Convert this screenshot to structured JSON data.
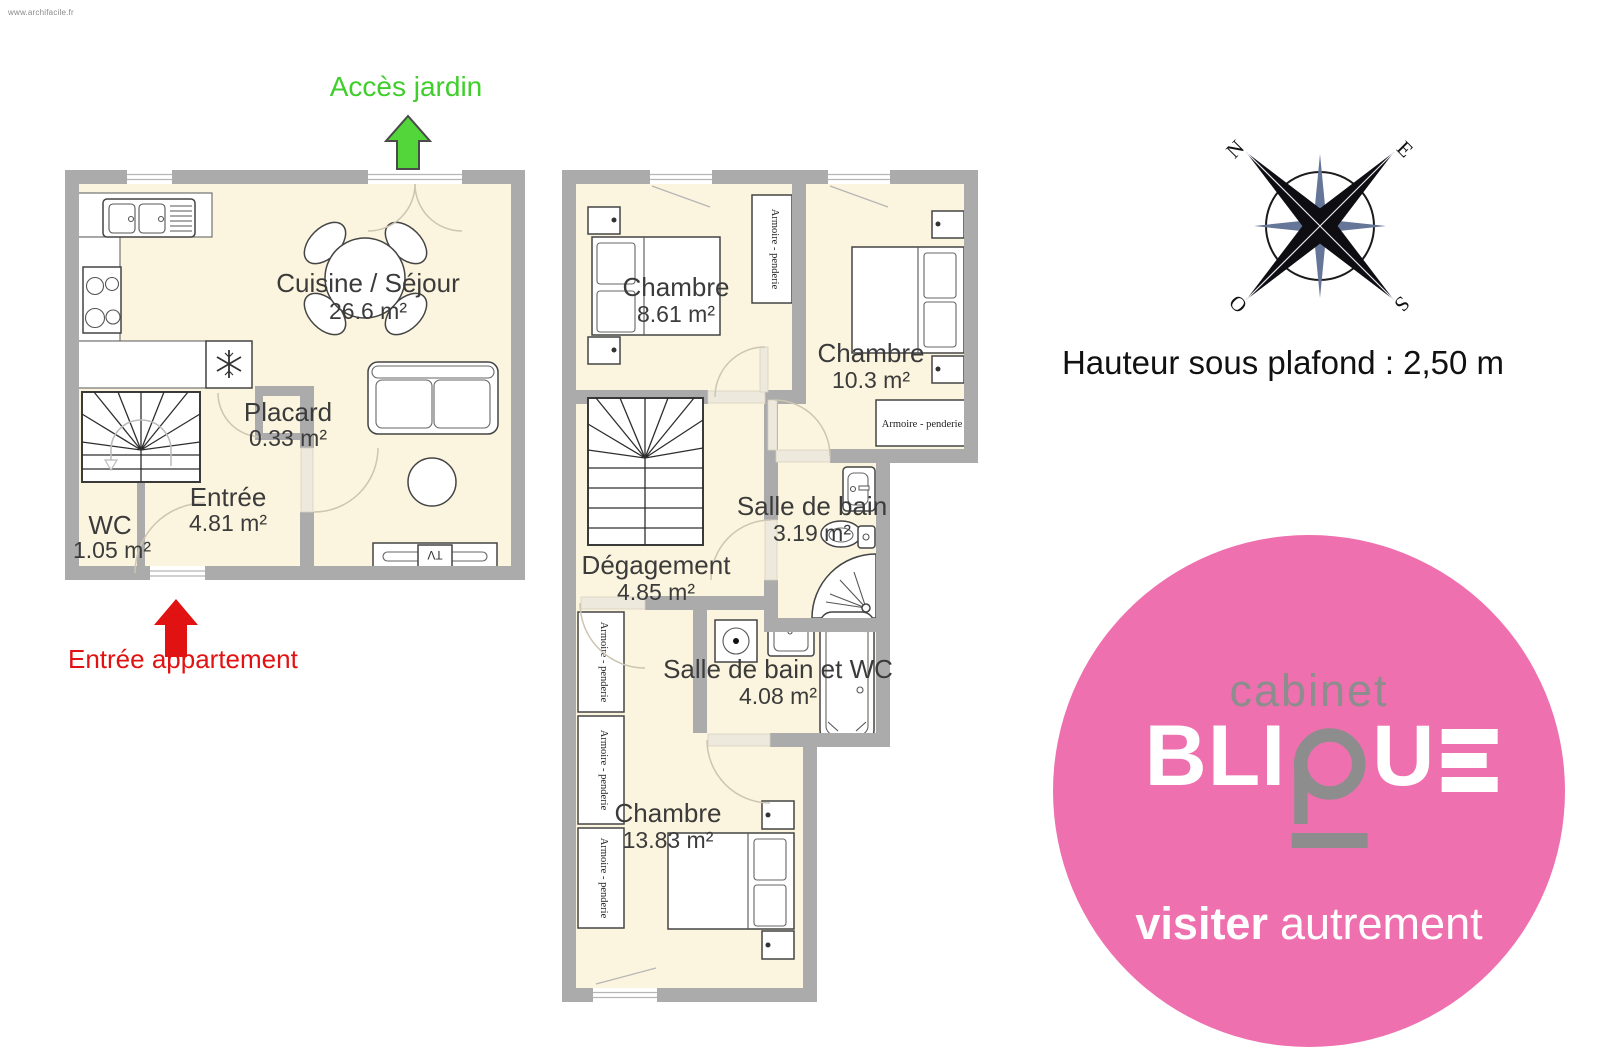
{
  "page": {
    "watermark": "www.archifacile.fr"
  },
  "annotations": {
    "garden_access": "Accès jardin",
    "apartment_entrance": "Entrée appartement",
    "ceiling_height": "Hauteur sous plafond : 2,50 m"
  },
  "compass": {
    "north": "N",
    "east": "E",
    "south": "S",
    "west": "O"
  },
  "floors": {
    "ground": {
      "rooms": [
        {
          "name": "Cuisine / Séjour",
          "area": "26.6 m²"
        },
        {
          "name": "Placard",
          "area": "0.33 m²"
        },
        {
          "name": "Entrée",
          "area": "4.81 m²"
        },
        {
          "name": "WC",
          "area": "1.05 m²"
        }
      ]
    },
    "upper": {
      "rooms": [
        {
          "name": "Chambre",
          "area": "8.61 m²"
        },
        {
          "name": "Chambre",
          "area": "10.3 m²"
        },
        {
          "name": "Salle de bain",
          "area": "3.19 m²"
        },
        {
          "name": "Dégagement",
          "area": "4.85 m²"
        },
        {
          "name": "Salle de bain et WC",
          "area": "4.08 m²"
        },
        {
          "name": "Chambre",
          "area": "13.83 m²"
        }
      ]
    }
  },
  "furniture": {
    "wardrobe": "Armoire - penderie",
    "tv": "TV"
  },
  "logo": {
    "line1": "cabinet",
    "word": "BLIQUE",
    "word_bli": "BLI",
    "word_u": "U",
    "tagline_bold": "visiter",
    "tagline_light": "autrement",
    "circle_color": "#EF70AE",
    "accent_gray": "#8D8D8D"
  },
  "colors": {
    "wall": "#ABABAB",
    "floor": "#FBF4DE",
    "green": "#3FCE2B",
    "green_arrow": "#52D639",
    "red": "#E11212"
  }
}
